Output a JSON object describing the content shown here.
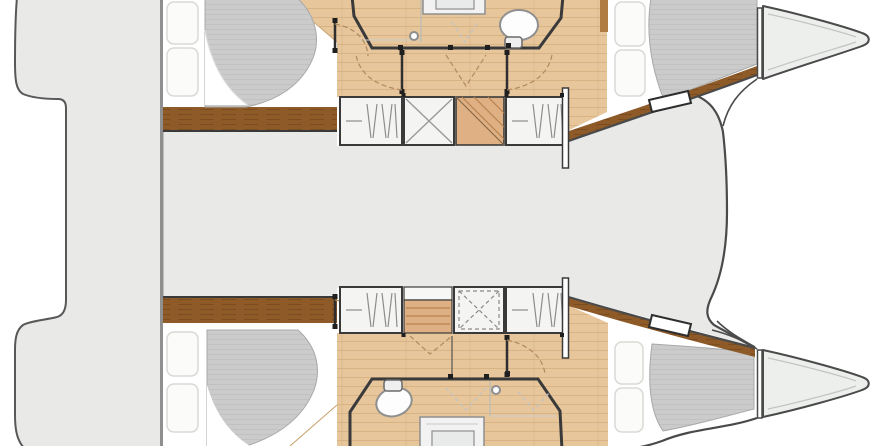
{
  "page": {
    "title": "Catamaran interior layout floor plan"
  },
  "colors": {
    "background": "#ffffff",
    "deck": "#e9eae8",
    "deck_outline": "#585858",
    "divider": "#8f8f8f",
    "floor_wood": "#e7c69c",
    "floor_wood_line": "#c49a66",
    "trim_wood": "#8d5a28",
    "trim_wood_line": "#73451a",
    "stair_wood": "#deb083",
    "mattress": "#cbcbcb",
    "mattress_line": "#c1c1c1",
    "bed_base": "#ffffff",
    "pillow": "#fbfbf9",
    "pillow_outline": "#d9d9d6",
    "wall": "#3a3a3a",
    "hull_outline": "#4a4a4a",
    "fixture": "#8f8f8f",
    "cabinet": "#f4f4f2",
    "bath_floor": "#eceded",
    "bow_deck": "#edefed",
    "wood_sliver": "#b07c43",
    "swing_dash": "#b08a5e"
  }
}
